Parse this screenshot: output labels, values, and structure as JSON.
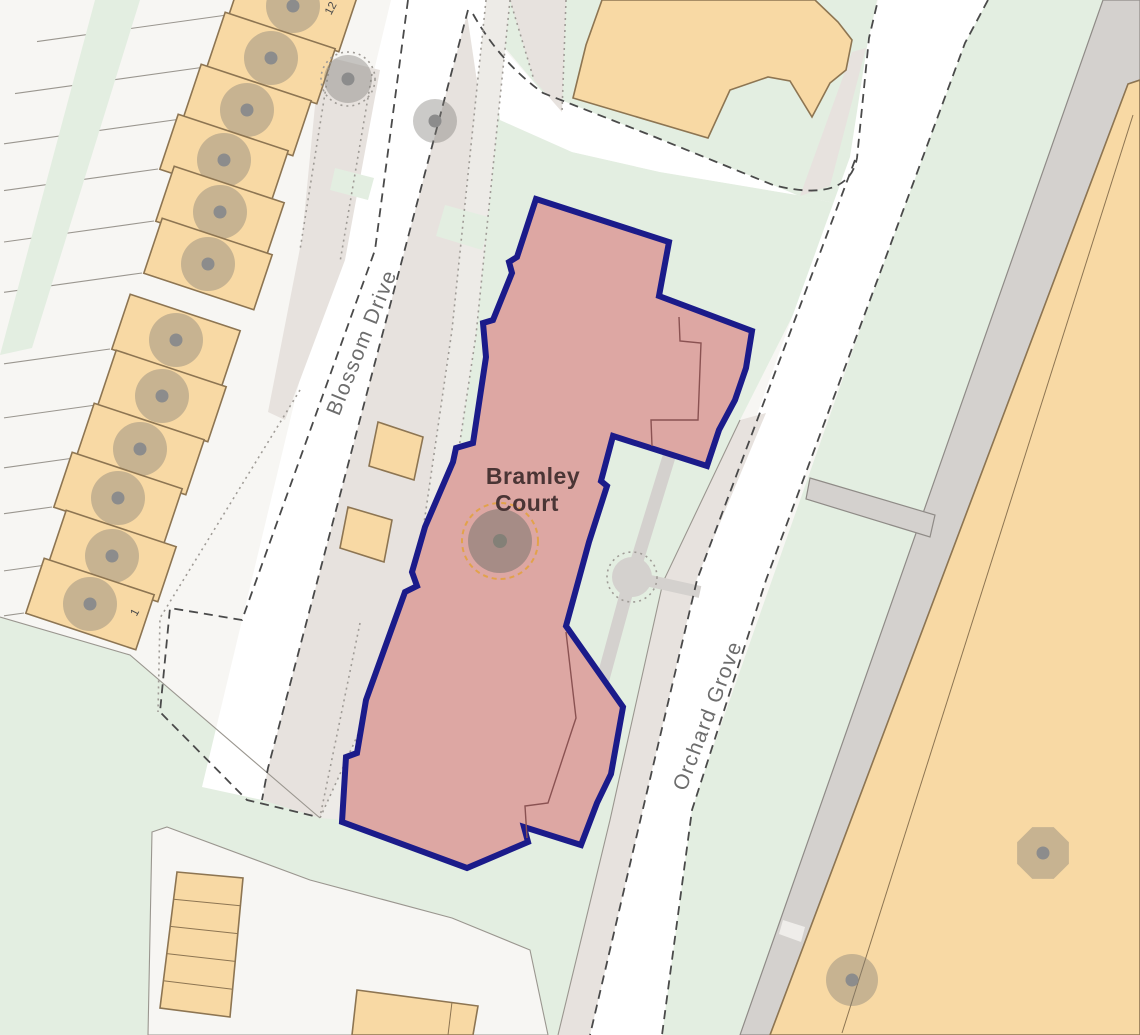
{
  "title": "Bramley Court site location map",
  "labels": {
    "property_line1": "Bramley",
    "property_line2": "Court",
    "street_blossom": "Blossom Drive",
    "street_orchard": "Orchard Grove",
    "plot_number_south": "1",
    "plot_number_north": "12"
  },
  "colors": {
    "background": "#f7f6f3",
    "road": "#ffffff",
    "green": "#e3eee1",
    "pavement": "#e7e2de",
    "footpath": "#edebe7",
    "path_gray": "#d4d1ce",
    "path_edge": "#8f8b87",
    "building_fill": "#f8d9a4",
    "building_stroke": "#8d7552",
    "highlight_fill": "#dda7a3",
    "highlight_border": "#1b1b8a",
    "interior_line": "#8a5252",
    "tree_fill": "rgba(125,122,117,0.40)",
    "tree_dot": "#8c8c8c",
    "tree_ring": "#e2a24b",
    "boundary_dash": "#4a4a4a",
    "dotted": "#9f9b96",
    "hairline": "#9a968f",
    "street_text": "#6d6d6d",
    "property_text": "#4a3535"
  },
  "map": {
    "terrace_tree_centers": [
      [
        293,
        6
      ],
      [
        271,
        58
      ],
      [
        247,
        110
      ],
      [
        224,
        160
      ],
      [
        220,
        212
      ],
      [
        208,
        264
      ],
      [
        176,
        340
      ],
      [
        162,
        396
      ],
      [
        140,
        449
      ],
      [
        118,
        498
      ],
      [
        112,
        556
      ],
      [
        90,
        604
      ]
    ],
    "standalone_trees": [
      {
        "x": 348,
        "y": 79,
        "r": 24,
        "shape": "circle",
        "dotted_ring": true
      },
      {
        "x": 435,
        "y": 121,
        "r": 22,
        "shape": "circle",
        "dotted_ring": false
      },
      {
        "x": 1043,
        "y": 853,
        "r": 28,
        "shape": "octagon",
        "dotted_ring": false
      },
      {
        "x": 852,
        "y": 980,
        "r": 26,
        "shape": "circle",
        "dotted_ring": false
      }
    ],
    "center_tree": {
      "x": 500,
      "y": 541,
      "r": 32,
      "ring_r": 38,
      "dot_r": 7
    }
  }
}
